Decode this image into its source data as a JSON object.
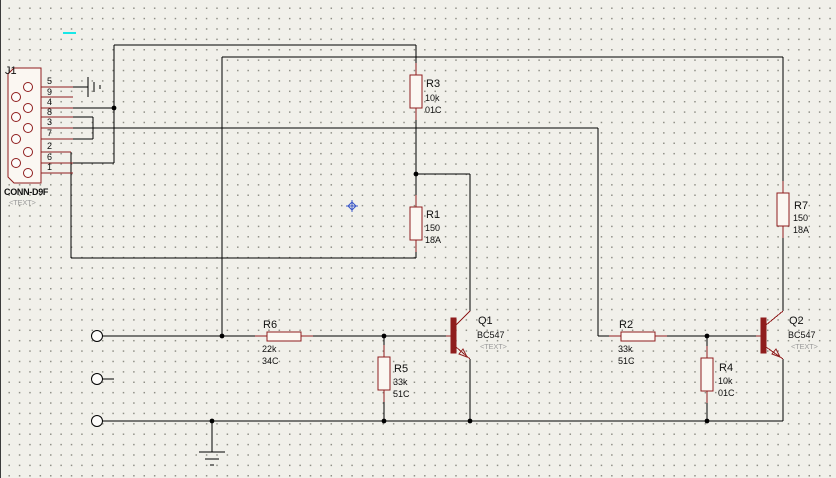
{
  "meta": {
    "app_context": "schematic-capture-canvas",
    "colors": {
      "background": "#f1f0ea",
      "grid_dot": "#8f8f86",
      "wire": "#000000",
      "component": "#8f1d1d",
      "component_fill": "#fbf7f2",
      "muted_text": "#9b9b9b",
      "cursor_blue": "#3a57c9",
      "artifact_cyan": "#17e7e7"
    },
    "grid_spacing_px": 10.4
  },
  "connector": {
    "ref": "J1",
    "part": "CONN-D9F",
    "placeholder": "<TEXT>",
    "body_points": "7,74 13,68 40,68 40,183 13,183 7,177",
    "holes": [
      [
        27,
        87
      ],
      [
        15,
        97
      ],
      [
        27,
        108
      ],
      [
        15,
        117
      ],
      [
        27,
        128
      ],
      [
        15,
        139
      ],
      [
        27,
        152
      ],
      [
        15,
        163
      ],
      [
        27,
        173
      ]
    ],
    "pin_numbers": [
      "5",
      "9",
      "4",
      "8",
      "3",
      "7",
      "2",
      "6",
      "1"
    ]
  },
  "components": {
    "resistors": [
      {
        "ref": "R3",
        "value": "10k",
        "code": "01C",
        "orientation": "vertical"
      },
      {
        "ref": "R1",
        "value": "150",
        "code": "18A",
        "orientation": "vertical"
      },
      {
        "ref": "R7",
        "value": "150",
        "code": "18A",
        "orientation": "vertical"
      },
      {
        "ref": "R6",
        "value": "22k",
        "code": "34C",
        "orientation": "horizontal"
      },
      {
        "ref": "R5",
        "value": "33k",
        "code": "51C",
        "orientation": "vertical"
      },
      {
        "ref": "R2",
        "value": "33k",
        "code": "51C",
        "orientation": "horizontal"
      },
      {
        "ref": "R4",
        "value": "10k",
        "code": "01C",
        "orientation": "vertical"
      }
    ],
    "transistors": [
      {
        "ref": "Q1",
        "part": "BC547",
        "placeholder": "<TEXT>"
      },
      {
        "ref": "Q2",
        "part": "BC547",
        "placeholder": "<TEXT>"
      }
    ]
  },
  "texts": [
    {
      "x": 4,
      "y": 74,
      "s": "J1",
      "c": "ref",
      "name": "label-j1-ref"
    },
    {
      "x": 3,
      "y": 195,
      "s": "CONN-D9F",
      "c": "prt",
      "name": "label-j1-part"
    },
    {
      "x": 8,
      "y": 205,
      "s": "<TEXT>",
      "c": "mut",
      "name": "label-j1-placeholder"
    },
    {
      "x": 46,
      "y": 84,
      "s": "5",
      "c": "pin",
      "name": "pin-label-5"
    },
    {
      "x": 46,
      "y": 95,
      "s": "9",
      "c": "pin",
      "name": "pin-label-9"
    },
    {
      "x": 46,
      "y": 105,
      "s": "4",
      "c": "pin",
      "name": "pin-label-4"
    },
    {
      "x": 46,
      "y": 115,
      "s": "8",
      "c": "pin",
      "name": "pin-label-8"
    },
    {
      "x": 46,
      "y": 125,
      "s": "3",
      "c": "pin",
      "name": "pin-label-3"
    },
    {
      "x": 46,
      "y": 136,
      "s": "7",
      "c": "pin",
      "name": "pin-label-7"
    },
    {
      "x": 46,
      "y": 149,
      "s": "2",
      "c": "pin",
      "name": "pin-label-2"
    },
    {
      "x": 46,
      "y": 160,
      "s": "6",
      "c": "pin",
      "name": "pin-label-6"
    },
    {
      "x": 46,
      "y": 170,
      "s": "1",
      "c": "pin",
      "name": "pin-label-1"
    },
    {
      "x": 425,
      "y": 87,
      "s": "R3",
      "c": "ref",
      "name": "label-r3-ref"
    },
    {
      "x": 424,
      "y": 101,
      "s": "10k",
      "c": "val",
      "name": "label-r3-value"
    },
    {
      "x": 424,
      "y": 113,
      "s": "01C",
      "c": "val",
      "name": "label-r3-code"
    },
    {
      "x": 425,
      "y": 218,
      "s": "R1",
      "c": "ref",
      "name": "label-r1-ref"
    },
    {
      "x": 424,
      "y": 231,
      "s": "150",
      "c": "val",
      "name": "label-r1-value"
    },
    {
      "x": 424,
      "y": 243,
      "s": "18A",
      "c": "val",
      "name": "label-r1-code"
    },
    {
      "x": 793,
      "y": 209,
      "s": "R7",
      "c": "ref",
      "name": "label-r7-ref"
    },
    {
      "x": 792,
      "y": 221,
      "s": "150",
      "c": "val",
      "name": "label-r7-value"
    },
    {
      "x": 792,
      "y": 233,
      "s": "18A",
      "c": "val",
      "name": "label-r7-code"
    },
    {
      "x": 262,
      "y": 328,
      "s": "R6",
      "c": "ref",
      "name": "label-r6-ref"
    },
    {
      "x": 261,
      "y": 352,
      "s": "22k",
      "c": "val",
      "name": "label-r6-value"
    },
    {
      "x": 261,
      "y": 364,
      "s": "34C",
      "c": "val",
      "name": "label-r6-code"
    },
    {
      "x": 393,
      "y": 372,
      "s": "R5",
      "c": "ref",
      "name": "label-r5-ref"
    },
    {
      "x": 392,
      "y": 385,
      "s": "33k",
      "c": "val",
      "name": "label-r5-value"
    },
    {
      "x": 392,
      "y": 397,
      "s": "51C",
      "c": "val",
      "name": "label-r5-code"
    },
    {
      "x": 618,
      "y": 328,
      "s": "R2",
      "c": "ref",
      "name": "label-r2-ref"
    },
    {
      "x": 617,
      "y": 352,
      "s": "33k",
      "c": "val",
      "name": "label-r2-value"
    },
    {
      "x": 617,
      "y": 364,
      "s": "51C",
      "c": "val",
      "name": "label-r2-code"
    },
    {
      "x": 718,
      "y": 371,
      "s": "R4",
      "c": "ref",
      "name": "label-r4-ref"
    },
    {
      "x": 717,
      "y": 384,
      "s": "10k",
      "c": "val",
      "name": "label-r4-value"
    },
    {
      "x": 717,
      "y": 396,
      "s": "01C",
      "c": "val",
      "name": "label-r4-code"
    },
    {
      "x": 477,
      "y": 324,
      "s": "Q1",
      "c": "ref",
      "name": "label-q1-ref"
    },
    {
      "x": 476,
      "y": 338,
      "s": "BC547",
      "c": "val",
      "name": "label-q1-part"
    },
    {
      "x": 479,
      "y": 349,
      "s": "<TEXT>",
      "c": "mut",
      "name": "label-q1-placeholder"
    },
    {
      "x": 788,
      "y": 324,
      "s": "Q2",
      "c": "ref",
      "name": "label-q2-ref"
    },
    {
      "x": 787,
      "y": 338,
      "s": "BC547",
      "c": "val",
      "name": "label-q2-part"
    },
    {
      "x": 790,
      "y": 349,
      "s": "<TEXT>",
      "c": "mut",
      "name": "label-q2-placeholder"
    }
  ],
  "wires": [
    [
      113,
      45,
      415,
      45
    ],
    [
      113,
      45,
      113,
      163
    ],
    [
      72,
      108,
      113,
      108
    ],
    [
      72,
      163,
      113,
      163
    ],
    [
      72,
      87,
      87,
      87
    ],
    [
      72,
      117,
      92,
      117
    ],
    [
      92,
      117,
      92,
      139
    ],
    [
      72,
      139,
      92,
      139
    ],
    [
      72,
      128,
      597,
      128
    ],
    [
      597,
      128,
      597,
      336
    ],
    [
      597,
      336,
      608,
      336
    ],
    [
      70,
      152,
      70,
      258
    ],
    [
      70,
      258,
      415,
      258
    ],
    [
      415,
      252,
      415,
      258
    ],
    [
      415,
      45,
      415,
      63
    ],
    [
      415,
      120,
      415,
      174
    ],
    [
      415,
      174,
      415,
      195
    ],
    [
      415,
      174,
      469,
      174
    ],
    [
      469,
      174,
      469,
      311
    ],
    [
      102,
      336,
      254,
      336
    ],
    [
      221,
      57,
      221,
      336
    ],
    [
      221,
      57,
      782,
      57
    ],
    [
      782,
      57,
      782,
      181
    ],
    [
      782,
      238,
      782,
      311
    ],
    [
      312,
      336,
      445,
      336
    ],
    [
      383,
      336,
      383,
      345
    ],
    [
      383,
      402,
      383,
      421
    ],
    [
      666,
      336,
      755,
      336
    ],
    [
      706,
      336,
      706,
      346
    ],
    [
      706,
      403,
      706,
      421
    ],
    [
      102,
      421,
      782,
      421
    ],
    [
      782,
      359,
      782,
      421
    ],
    [
      469,
      359,
      469,
      421
    ],
    [
      102,
      379,
      113,
      379
    ],
    [
      211,
      421,
      211,
      452
    ]
  ],
  "red_lines": [
    [
      31,
      87,
      72,
      87
    ],
    [
      19,
      97,
      72,
      97
    ],
    [
      31,
      108,
      72,
      108
    ],
    [
      19,
      117,
      72,
      117
    ],
    [
      31,
      128,
      72,
      128
    ],
    [
      19,
      139,
      72,
      139
    ],
    [
      31,
      152,
      70,
      152
    ],
    [
      19,
      163,
      72,
      163
    ],
    [
      31,
      173,
      72,
      173
    ],
    [
      415,
      63,
      415,
      75
    ],
    [
      415,
      108,
      415,
      120
    ],
    [
      415,
      195,
      415,
      207
    ],
    [
      415,
      240,
      415,
      252
    ],
    [
      782,
      181,
      782,
      193
    ],
    [
      782,
      226,
      782,
      238
    ],
    [
      383,
      345,
      383,
      357
    ],
    [
      383,
      390,
      383,
      402
    ],
    [
      706,
      346,
      706,
      358
    ],
    [
      706,
      391,
      706,
      403
    ],
    [
      254,
      336,
      266,
      336
    ],
    [
      300,
      336,
      312,
      336
    ],
    [
      608,
      336,
      620,
      336
    ],
    [
      654,
      336,
      666,
      336
    ],
    [
      445,
      336,
      450,
      336
    ],
    [
      455,
      325,
      469,
      311
    ],
    [
      455,
      347,
      469,
      359
    ],
    [
      755,
      336,
      760,
      336
    ],
    [
      765,
      325,
      782,
      311
    ],
    [
      765,
      347,
      782,
      359
    ]
  ],
  "bodies": [
    {
      "x": 409,
      "y": 75,
      "w": 12,
      "h": 33,
      "name": "resistor-R3"
    },
    {
      "x": 409,
      "y": 207,
      "w": 12,
      "h": 33,
      "name": "resistor-R1"
    },
    {
      "x": 776,
      "y": 193,
      "w": 12,
      "h": 33,
      "name": "resistor-R7"
    },
    {
      "x": 377,
      "y": 357,
      "w": 12,
      "h": 33,
      "name": "resistor-R5"
    },
    {
      "x": 700,
      "y": 358,
      "w": 12,
      "h": 33,
      "name": "resistor-R4"
    },
    {
      "x": 266,
      "y": 332,
      "w": 34,
      "h": 9,
      "name": "resistor-R6"
    },
    {
      "x": 620,
      "y": 332,
      "w": 34,
      "h": 9,
      "name": "resistor-R2"
    }
  ],
  "bars": [
    {
      "x": 450,
      "y": 318,
      "w": 5,
      "h": 35,
      "name": "transistor-Q1-base-bar"
    },
    {
      "x": 760,
      "y": 318,
      "w": 5,
      "h": 35,
      "name": "transistor-Q2-base-bar"
    }
  ],
  "arrows": [
    {
      "points": "466,357 458,354 462,349",
      "name": "q1-emitter-arrow"
    },
    {
      "points": "779,357 771,354 775,349",
      "name": "q2-emitter-arrow"
    }
  ],
  "terminals": [
    [
      96,
      336
    ],
    [
      96,
      379
    ],
    [
      96,
      421
    ]
  ],
  "dots": [
    [
      113,
      108
    ],
    [
      221,
      336
    ],
    [
      383,
      336
    ],
    [
      415,
      174
    ],
    [
      706,
      336
    ],
    [
      211,
      421
    ],
    [
      383,
      421
    ],
    [
      469,
      421
    ],
    [
      706,
      421
    ]
  ],
  "ground_bars": [
    [
      87,
      77,
      87,
      97
    ],
    [
      93,
      82,
      93,
      92
    ],
    [
      99,
      85,
      99,
      89
    ],
    [
      198,
      452,
      224,
      452
    ],
    [
      204,
      459,
      218,
      459
    ],
    [
      209,
      465,
      213,
      465
    ]
  ],
  "markers": {
    "cyan_artifact": {
      "x": 62,
      "y": 32,
      "w": 13,
      "h": 2
    },
    "blue_cursor": {
      "x": 351,
      "y": 206
    }
  }
}
